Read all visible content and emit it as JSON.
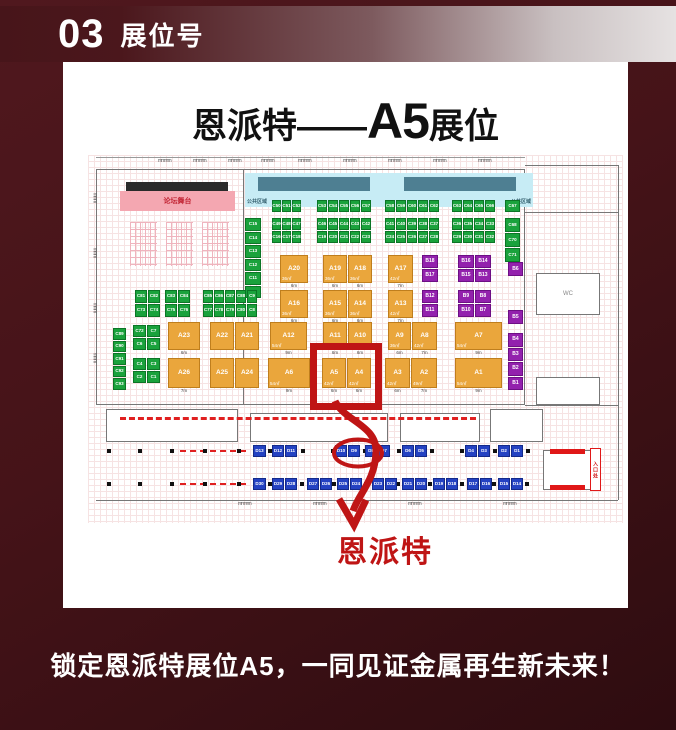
{
  "header": {
    "number": "03",
    "title": "展位号"
  },
  "card": {
    "title_prefix": "恩派特——",
    "title_booth": "A5",
    "title_suffix": "展位"
  },
  "annotation": {
    "label": "恩派特",
    "highlight_booth": "A5",
    "color": "#bf1515"
  },
  "caption": {
    "text": "锁定恩派特展位A5，一同见证金属再生新未来！"
  },
  "floorplan": {
    "stage_label": "论坛舞台",
    "public_label": "公共区域",
    "wc_label": "WC",
    "entrance_label": "入口处",
    "colors": {
      "green": "#1aa23c",
      "orange": "#eaa63c",
      "purple": "#9321ad",
      "blue": "#2442c2",
      "stage_pink": "#f4a7b1",
      "band_cyan": "#c7ecf5",
      "band_bar": "#4e7f92",
      "red": "#bf1515"
    },
    "blocks": {
      "green": [
        {
          "x": 184,
          "y": 45,
          "cw": 10,
          "rows": [
            [
              "C50",
              "C51",
              "C52"
            ]
          ]
        },
        {
          "x": 229,
          "y": 45,
          "cw": 11,
          "rows": [
            [
              "C53",
              "C54",
              "C55",
              "C56",
              "C57"
            ]
          ]
        },
        {
          "x": 297,
          "y": 45,
          "cw": 11,
          "rows": [
            [
              "C58",
              "C59",
              "C60",
              "C61",
              "C62"
            ]
          ]
        },
        {
          "x": 364,
          "y": 45,
          "cw": 11,
          "rows": [
            [
              "C63",
              "C64",
              "C65",
              "C66"
            ]
          ]
        },
        {
          "x": 417,
          "y": 45,
          "cw": 16,
          "rows": [
            [
              "C67"
            ]
          ]
        },
        {
          "x": 184,
          "y": 63,
          "cw": 10,
          "rows": [
            [
              "C49",
              "C48",
              "C47"
            ],
            [
              "C16",
              "C17",
              "C18"
            ]
          ]
        },
        {
          "x": 229,
          "y": 63,
          "cw": 11,
          "rows": [
            [
              "C46",
              "C45",
              "C44",
              "C43",
              "C42"
            ],
            [
              "C19",
              "C20",
              "C21",
              "C22",
              "C23"
            ]
          ]
        },
        {
          "x": 297,
          "y": 63,
          "cw": 11,
          "rows": [
            [
              "C41",
              "C40",
              "C39",
              "C38",
              "C37"
            ],
            [
              "C24",
              "C25",
              "C26",
              "C27",
              "C28"
            ]
          ]
        },
        {
          "x": 364,
          "y": 63,
          "cw": 11,
          "rows": [
            [
              "C36",
              "C35",
              "C34",
              "C33"
            ],
            [
              "C29",
              "C30",
              "C31",
              "C32"
            ]
          ]
        },
        {
          "x": 417,
          "y": 63,
          "cw": 16,
          "ch": 15,
          "rows": [
            [
              "C68"
            ],
            [
              "C70"
            ],
            [
              "C71"
            ]
          ]
        },
        {
          "x": 157,
          "y": 63,
          "cw": 17,
          "ch": 13.5,
          "rows": [
            [
              "C15"
            ],
            [
              "C14"
            ],
            [
              "C13"
            ],
            [
              "C12"
            ],
            [
              "C11"
            ],
            [
              "C10"
            ]
          ]
        },
        {
          "x": 47,
          "y": 135,
          "cw": 13,
          "ch": 14,
          "rows": [
            [
              "C81",
              "C82"
            ],
            [
              "C73",
              "C74"
            ]
          ]
        },
        {
          "x": 77,
          "y": 135,
          "cw": 13,
          "ch": 14,
          "rows": [
            [
              "C83",
              "C84"
            ],
            [
              "C75",
              "C76"
            ]
          ]
        },
        {
          "x": 115,
          "y": 135,
          "cw": 11,
          "ch": 14,
          "rows": [
            [
              "C85",
              "C86",
              "C87",
              "C88",
              "C9"
            ],
            [
              "C77",
              "C78",
              "C79",
              "C80",
              "C8"
            ]
          ]
        },
        {
          "x": 45,
          "y": 170,
          "cw": 14,
          "ch": 13,
          "rows": [
            [
              "C72",
              "C7"
            ],
            [
              "C6",
              "C5"
            ]
          ]
        },
        {
          "x": 45,
          "y": 203,
          "cw": 14,
          "ch": 13,
          "rows": [
            [
              "C4",
              "C3"
            ],
            [
              "C2",
              "C1"
            ]
          ]
        },
        {
          "x": 25,
          "y": 173,
          "cw": 14,
          "ch": 12.5,
          "rows": [
            [
              "C89"
            ],
            [
              "C90"
            ],
            [
              "C91"
            ],
            [
              "C92"
            ],
            [
              "C93"
            ]
          ]
        }
      ],
      "orange": [
        {
          "x": 192,
          "y": 100,
          "ch": 29,
          "rows": [
            [
              {
                "t": "A20",
                "s": "36㎡",
                "f": "6m",
                "w": 29
              }
            ]
          ]
        },
        {
          "x": 235,
          "y": 100,
          "ch": 29,
          "rows": [
            [
              {
                "t": "A19",
                "s": "36㎡",
                "f": "6m",
                "w": 25
              },
              {
                "t": "A18",
                "s": "36㎡",
                "f": "6m",
                "w": 25
              }
            ]
          ]
        },
        {
          "x": 300,
          "y": 100,
          "ch": 29,
          "rows": [
            [
              {
                "t": "A17",
                "s": "42㎡",
                "f": "7m",
                "w": 26
              }
            ]
          ]
        },
        {
          "x": 192,
          "y": 135,
          "ch": 29,
          "rows": [
            [
              {
                "t": "A16",
                "s": "36㎡",
                "f": "6m",
                "w": 29
              }
            ]
          ]
        },
        {
          "x": 235,
          "y": 135,
          "ch": 29,
          "rows": [
            [
              {
                "t": "A15",
                "s": "36㎡",
                "f": "6m",
                "w": 25
              },
              {
                "t": "A14",
                "s": "36㎡",
                "f": "6m",
                "w": 25
              }
            ]
          ]
        },
        {
          "x": 300,
          "y": 135,
          "ch": 29,
          "rows": [
            [
              {
                "t": "A13",
                "s": "42㎡",
                "f": "7m",
                "w": 26
              }
            ]
          ]
        },
        {
          "x": 80,
          "y": 167,
          "ch": 29,
          "rows": [
            [
              {
                "t": "A23",
                "f": "6m",
                "w": 33
              }
            ]
          ]
        },
        {
          "x": 122,
          "y": 167,
          "ch": 29,
          "rows": [
            [
              {
                "t": "A22",
                "w": 25
              },
              {
                "t": "A21",
                "w": 25
              }
            ]
          ]
        },
        {
          "x": 182,
          "y": 167,
          "ch": 29,
          "rows": [
            [
              {
                "t": "A12",
                "s": "54㎡",
                "f": "9m",
                "w": 38
              }
            ]
          ]
        },
        {
          "x": 235,
          "y": 167,
          "ch": 29,
          "rows": [
            [
              {
                "t": "A11",
                "s": "36㎡",
                "f": "6m",
                "w": 25
              },
              {
                "t": "A10",
                "s": "36㎡",
                "f": "6m",
                "w": 25
              }
            ]
          ]
        },
        {
          "x": 300,
          "y": 167,
          "ch": 29,
          "rows": [
            [
              {
                "t": "A9",
                "s": "36㎡",
                "f": "6m",
                "w": 24
              },
              {
                "t": "A8",
                "s": "42㎡",
                "f": "7m",
                "w": 26
              }
            ]
          ]
        },
        {
          "x": 367,
          "y": 167,
          "ch": 29,
          "rows": [
            [
              {
                "t": "A7",
                "s": "54㎡",
                "f": "9m",
                "w": 48
              }
            ]
          ]
        },
        {
          "x": 80,
          "y": 203,
          "ch": 31,
          "rows": [
            [
              {
                "t": "A26",
                "f": "7m",
                "w": 33
              }
            ]
          ]
        },
        {
          "x": 122,
          "y": 203,
          "ch": 31,
          "rows": [
            [
              {
                "t": "A25",
                "w": 25
              },
              {
                "t": "A24",
                "w": 25
              }
            ]
          ]
        },
        {
          "x": 180,
          "y": 203,
          "ch": 31,
          "rows": [
            [
              {
                "t": "A6",
                "s": "54㎡",
                "f": "9m",
                "w": 43
              }
            ]
          ]
        },
        {
          "x": 234,
          "y": 203,
          "ch": 31,
          "rows": [
            [
              {
                "t": "A5",
                "s": "42㎡",
                "f": "6m",
                "w": 25
              },
              {
                "t": "A4",
                "s": "42㎡",
                "f": "6m",
                "w": 25
              }
            ]
          ]
        },
        {
          "x": 297,
          "y": 203,
          "ch": 31,
          "rows": [
            [
              {
                "t": "A3",
                "s": "42㎡",
                "f": "6m",
                "w": 26
              },
              {
                "t": "A2",
                "s": "49㎡",
                "f": "7m",
                "w": 27
              }
            ]
          ]
        },
        {
          "x": 367,
          "y": 203,
          "ch": 31,
          "rows": [
            [
              {
                "t": "A1",
                "s": "54㎡",
                "f": "9m",
                "w": 48
              }
            ]
          ]
        }
      ],
      "purple": [
        {
          "x": 334,
          "y": 100,
          "cw": 17,
          "ch": 14,
          "rows": [
            [
              "B18"
            ],
            [
              "B17"
            ]
          ]
        },
        {
          "x": 370,
          "y": 100,
          "cw": 17,
          "ch": 14,
          "rows": [
            [
              "B16",
              "B14"
            ],
            [
              "B15",
              "B13"
            ]
          ]
        },
        {
          "x": 334,
          "y": 135,
          "cw": 17,
          "ch": 14,
          "rows": [
            [
              "B12"
            ],
            [
              "B11"
            ]
          ]
        },
        {
          "x": 370,
          "y": 135,
          "cw": 17,
          "ch": 14,
          "rows": [
            [
              "B9",
              "B8"
            ],
            [
              "B10",
              "B7"
            ]
          ]
        },
        {
          "x": 420,
          "y": 107,
          "cw": 16,
          "ch": 15,
          "rows": [
            [
              "B6"
            ]
          ]
        },
        {
          "x": 420,
          "y": 155,
          "cw": 16,
          "ch": 15,
          "rows": [
            [
              "B5"
            ]
          ]
        },
        {
          "x": 420,
          "y": 178,
          "cw": 16,
          "ch": 14.5,
          "rows": [
            [
              "B4"
            ],
            [
              "B3"
            ],
            [
              "B2"
            ],
            [
              "B1"
            ]
          ]
        }
      ],
      "blue": [
        {
          "x": 165,
          "y": 290,
          "cw": 14,
          "rows": [
            [
              "D13"
            ]
          ]
        },
        {
          "x": 184,
          "y": 290,
          "rows": [
            [
              "D12",
              "D11"
            ]
          ]
        },
        {
          "x": 247,
          "y": 290,
          "rows": [
            [
              "D10",
              "D9"
            ]
          ]
        },
        {
          "x": 277,
          "y": 290,
          "rows": [
            [
              "D8",
              "D7"
            ]
          ]
        },
        {
          "x": 314,
          "y": 290,
          "rows": [
            [
              "D6",
              "D5"
            ]
          ]
        },
        {
          "x": 377,
          "y": 290,
          "rows": [
            [
              "D4",
              "D3"
            ]
          ]
        },
        {
          "x": 410,
          "y": 290,
          "rows": [
            [
              "D2",
              "D1"
            ]
          ]
        },
        {
          "x": 165,
          "y": 323,
          "cw": 14,
          "rows": [
            [
              "D30"
            ]
          ]
        },
        {
          "x": 184,
          "y": 323,
          "rows": [
            [
              "D29",
              "D28"
            ]
          ]
        },
        {
          "x": 219,
          "y": 323,
          "rows": [
            [
              "D27",
              "D26"
            ]
          ]
        },
        {
          "x": 249,
          "y": 323,
          "rows": [
            [
              "D25",
              "D24"
            ]
          ]
        },
        {
          "x": 284,
          "y": 323,
          "rows": [
            [
              "D23",
              "D22"
            ]
          ]
        },
        {
          "x": 314,
          "y": 323,
          "rows": [
            [
              "D21",
              "D20"
            ]
          ]
        },
        {
          "x": 345,
          "y": 323,
          "rows": [
            [
              "D19",
              "D18"
            ]
          ]
        },
        {
          "x": 379,
          "y": 323,
          "rows": [
            [
              "D17",
              "D16"
            ]
          ]
        },
        {
          "x": 410,
          "y": 323,
          "rows": [
            [
              "D15",
              "D14"
            ]
          ]
        }
      ]
    }
  }
}
